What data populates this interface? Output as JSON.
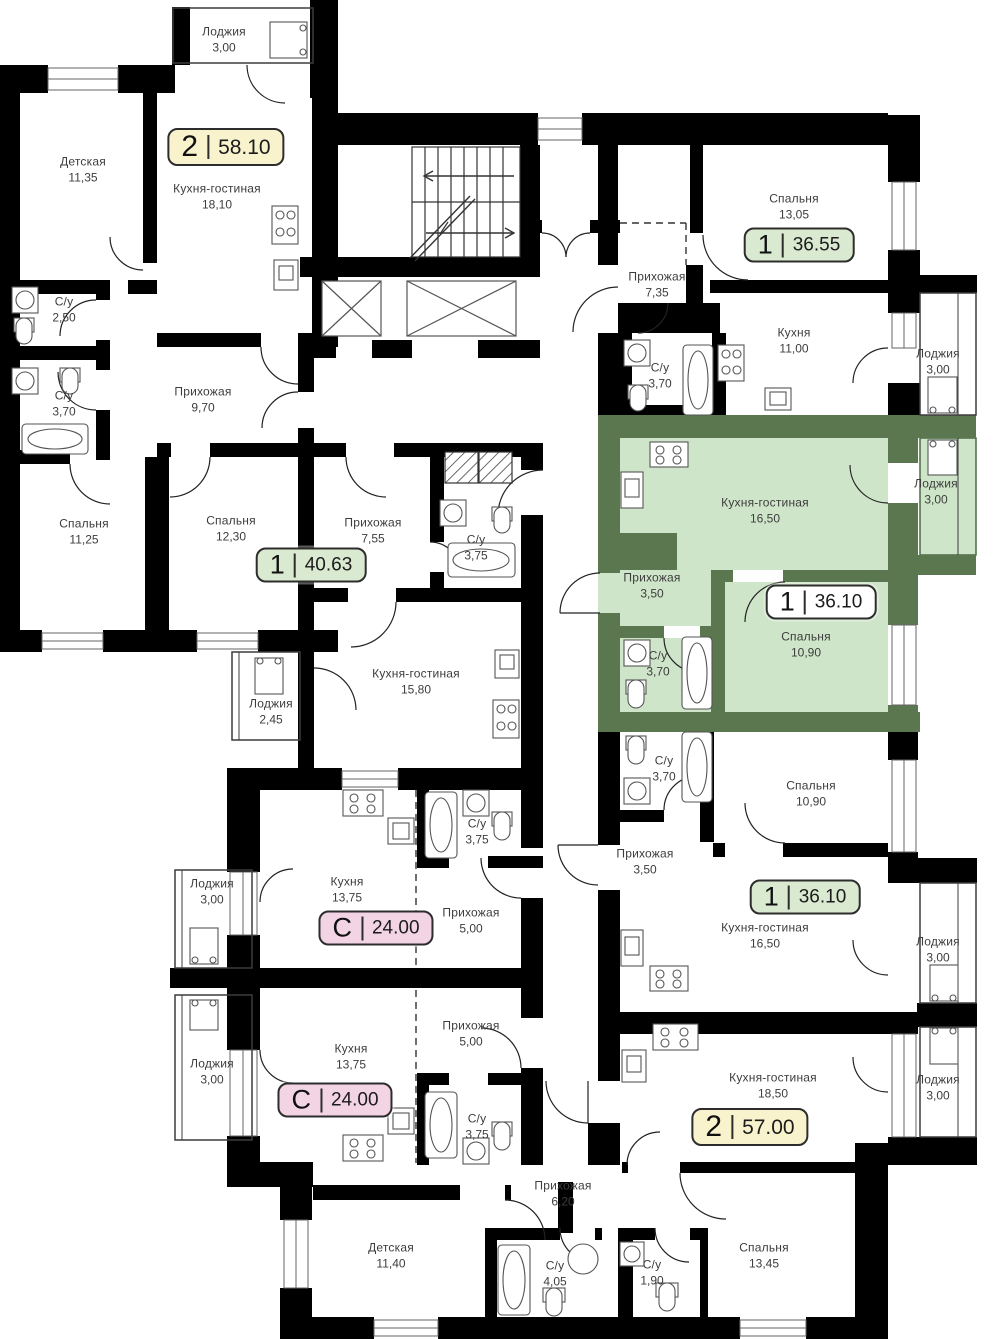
{
  "colors": {
    "wall": "#000000",
    "highlight_wall": "#5a7750",
    "highlight_room": "#cfe5c9",
    "badge_yellow": "#f8f3cd",
    "badge_green": "#d9ead1",
    "badge_pink": "#f3d4e5",
    "badge_white": "#ffffff",
    "label_text": "#3d3d3d"
  },
  "highlighted_apartment": {
    "rooms": "1",
    "area": "36.10"
  },
  "apartments": [
    {
      "rooms": "2",
      "area": "58.10",
      "style": "yellow"
    },
    {
      "rooms": "1",
      "area": "36.55",
      "style": "green"
    },
    {
      "rooms": "1",
      "area": "40.63",
      "style": "green"
    },
    {
      "rooms": "1",
      "area": "36.10",
      "style": "white-highlighted"
    },
    {
      "rooms": "1",
      "area": "36.10",
      "style": "green"
    },
    {
      "rooms": "С",
      "area": "24.00",
      "style": "pink"
    },
    {
      "rooms": "С",
      "area": "24.00",
      "style": "pink"
    },
    {
      "rooms": "2",
      "area": "57.00",
      "style": "yellow"
    }
  ],
  "rooms": [
    {
      "name": "Лоджия",
      "area": "3,00"
    },
    {
      "name": "Детская",
      "area": "11,35"
    },
    {
      "name": "Кухня-гостиная",
      "area": "18,10"
    },
    {
      "name": "С/у",
      "area": "2,50"
    },
    {
      "name": "С/у",
      "area": "3,70"
    },
    {
      "name": "Прихожая",
      "area": "9,70"
    },
    {
      "name": "Спальня",
      "area": "11,25"
    },
    {
      "name": "Спальня",
      "area": "12,30"
    },
    {
      "name": "Прихожая",
      "area": "7,55"
    },
    {
      "name": "С/у",
      "area": "3,75"
    },
    {
      "name": "Кухня-гостиная",
      "area": "15,80"
    },
    {
      "name": "Лоджия",
      "area": "2,45"
    },
    {
      "name": "Спальня",
      "area": "13,05"
    },
    {
      "name": "Прихожая",
      "area": "7,35"
    },
    {
      "name": "С/у",
      "area": "3,70"
    },
    {
      "name": "Кухня",
      "area": "11,00"
    },
    {
      "name": "Лоджия",
      "area": "3,00"
    },
    {
      "name": "Кухня-гостиная",
      "area": "16,50"
    },
    {
      "name": "Лоджия",
      "area": "3,00"
    },
    {
      "name": "Прихожая",
      "area": "3,50"
    },
    {
      "name": "Спальня",
      "area": "10,90"
    },
    {
      "name": "С/у",
      "area": "3,70"
    },
    {
      "name": "С/у",
      "area": "3,70"
    },
    {
      "name": "Спальня",
      "area": "10,90"
    },
    {
      "name": "Прихожая",
      "area": "3,50"
    },
    {
      "name": "Кухня-гостиная",
      "area": "16,50"
    },
    {
      "name": "Лоджия",
      "area": "3,00"
    },
    {
      "name": "Лоджия",
      "area": "3,00"
    },
    {
      "name": "Кухня",
      "area": "13,75"
    },
    {
      "name": "Прихожая",
      "area": "5,00"
    },
    {
      "name": "С/у",
      "area": "3,75"
    },
    {
      "name": "Лоджия",
      "area": "3,00"
    },
    {
      "name": "Кухня",
      "area": "13,75"
    },
    {
      "name": "Прихожая",
      "area": "5,00"
    },
    {
      "name": "С/у",
      "area": "3,75"
    },
    {
      "name": "Кухня-гостиная",
      "area": "18,50"
    },
    {
      "name": "Лоджия",
      "area": "3,00"
    },
    {
      "name": "Прихожая",
      "area": "6,20"
    },
    {
      "name": "Детская",
      "area": "11,40"
    },
    {
      "name": "С/у",
      "area": "4,05"
    },
    {
      "name": "С/у",
      "area": "1,90"
    },
    {
      "name": "Спальня",
      "area": "13,45"
    }
  ]
}
